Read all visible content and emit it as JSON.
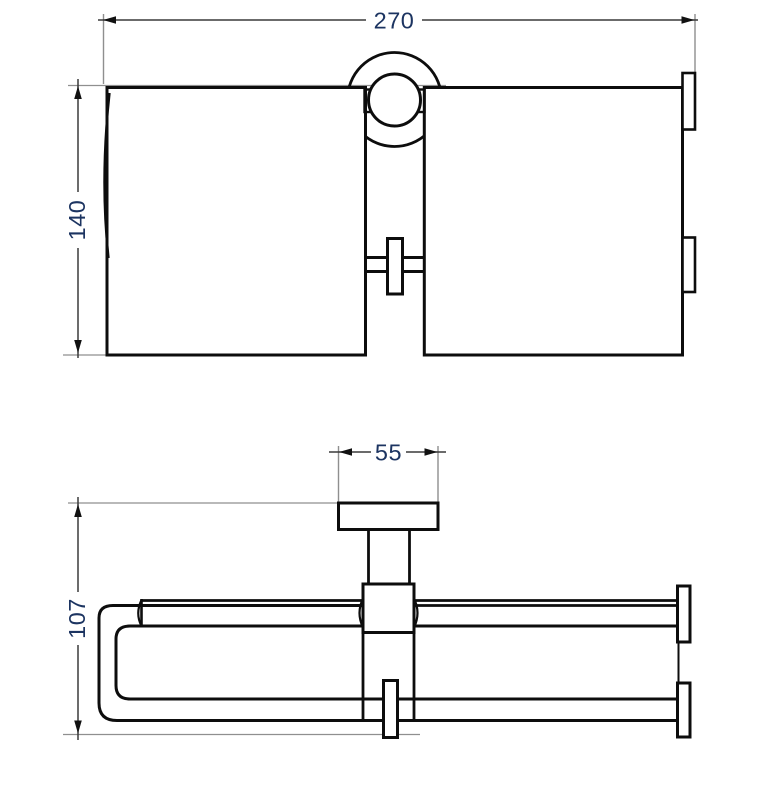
{
  "drawing": {
    "kind": "technical-drawing",
    "colors": {
      "outline": "#0d0d0d",
      "dimension_line": "#3a3a3a",
      "extension_line": "#8f8f8f",
      "label_text": "#1c3461",
      "background": "#ffffff"
    },
    "views": {
      "front": {
        "name": "front-elevation",
        "dimensions": {
          "width": "270",
          "height": "140"
        }
      },
      "plan": {
        "name": "top-plan",
        "dimensions": {
          "mount_plate_width": "55",
          "depth": "107"
        }
      }
    }
  }
}
